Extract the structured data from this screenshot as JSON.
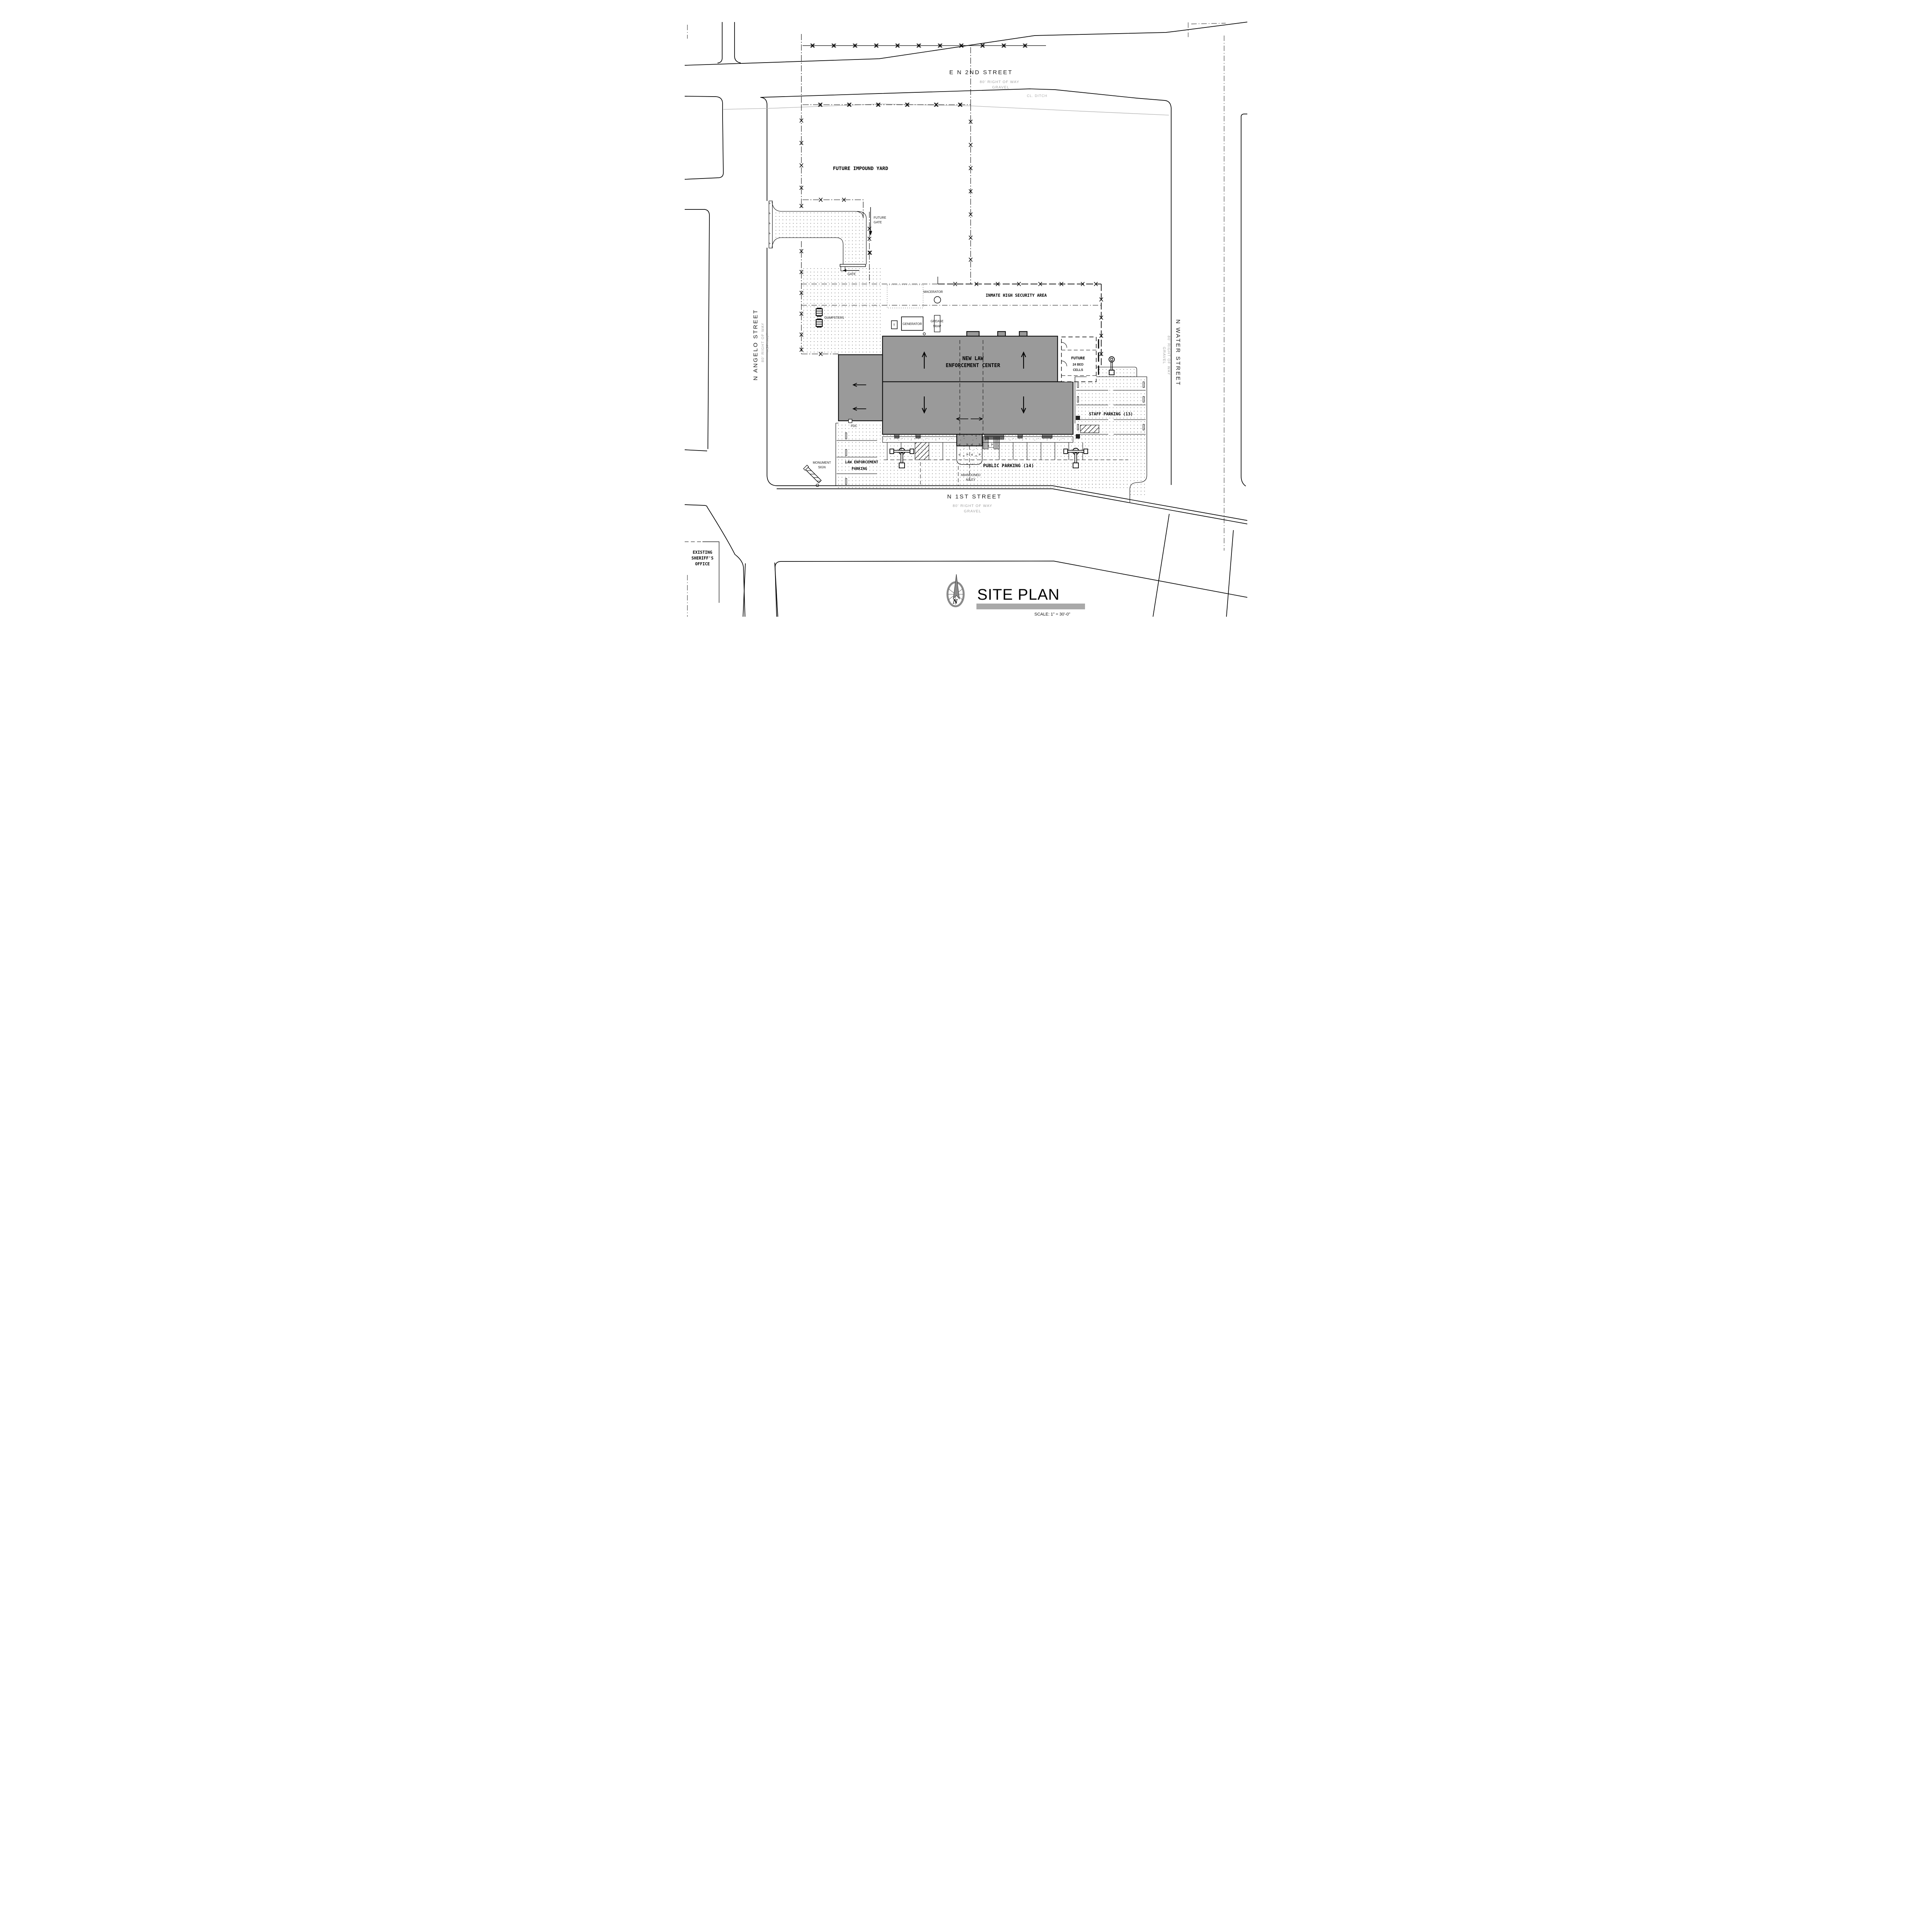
{
  "drawing": {
    "title": "SITE PLAN",
    "scale_note": "SCALE: 1\" = 30'-0\"",
    "north_icon": "compass-north-arrow"
  },
  "streets": {
    "north": {
      "name": "E N 2ND STREET",
      "right_of_way": "80' RIGHT OF WAY",
      "surface": "GRAVEL"
    },
    "west": {
      "name": "N ANGELO STREET",
      "right_of_way": "80' RIGHT OF WAY",
      "surface": "ASPHALT"
    },
    "east": {
      "name": "N WATER STREET",
      "right_of_way": "80' RIGHT OF WAY",
      "surface": "GRAVEL"
    },
    "south": {
      "name": "N 1ST STREET",
      "right_of_way": "80' RIGHT OF WAY",
      "surface": "GRAVEL"
    },
    "ditch_label": "CL. DITCH"
  },
  "site": {
    "impound_yard": "FUTURE IMPOUND YARD",
    "inmate_area": "INMATE HIGH SECURITY AREA",
    "building": {
      "line1": "NEW LAW",
      "line2": "ENFORCEMENT CENTER"
    },
    "future_cells": {
      "line1": "FUTURE",
      "line2": "24 BED",
      "line3": "CELLS"
    },
    "staff_parking": "STAFF PARKING (13)",
    "public_parking": "PUBLIC PARKING (14)",
    "le_parking": {
      "line1": "LAW ENFORCEMENT",
      "line2": "PARKING"
    },
    "abandoned_alley": {
      "line1": "ABANDONED",
      "line2": "ALLEY"
    },
    "existing_office": {
      "line1": "EXISTING",
      "line2": "SHERIFF'S",
      "line3": "OFFICE"
    },
    "monument_sign": {
      "line1": "MONUMENT",
      "line2": "SIGN"
    },
    "future_gate": {
      "line1": "FUTURE",
      "line2": "GATE"
    },
    "gate": "GATE",
    "fdc": "FDC",
    "dumpsters": "DUMPSTERS",
    "macerator": "MACERATOR",
    "generator": "GENERATOR",
    "transformer": "T",
    "grease_trap": {
      "line1": "GREASE",
      "line2": "TRAP"
    }
  },
  "colors": {
    "building": "#9a9a9a",
    "title_bar": "#a9a9a9",
    "compass": "#8a8a8a",
    "gray_text": "#9e9e9e",
    "line": "#000000"
  }
}
